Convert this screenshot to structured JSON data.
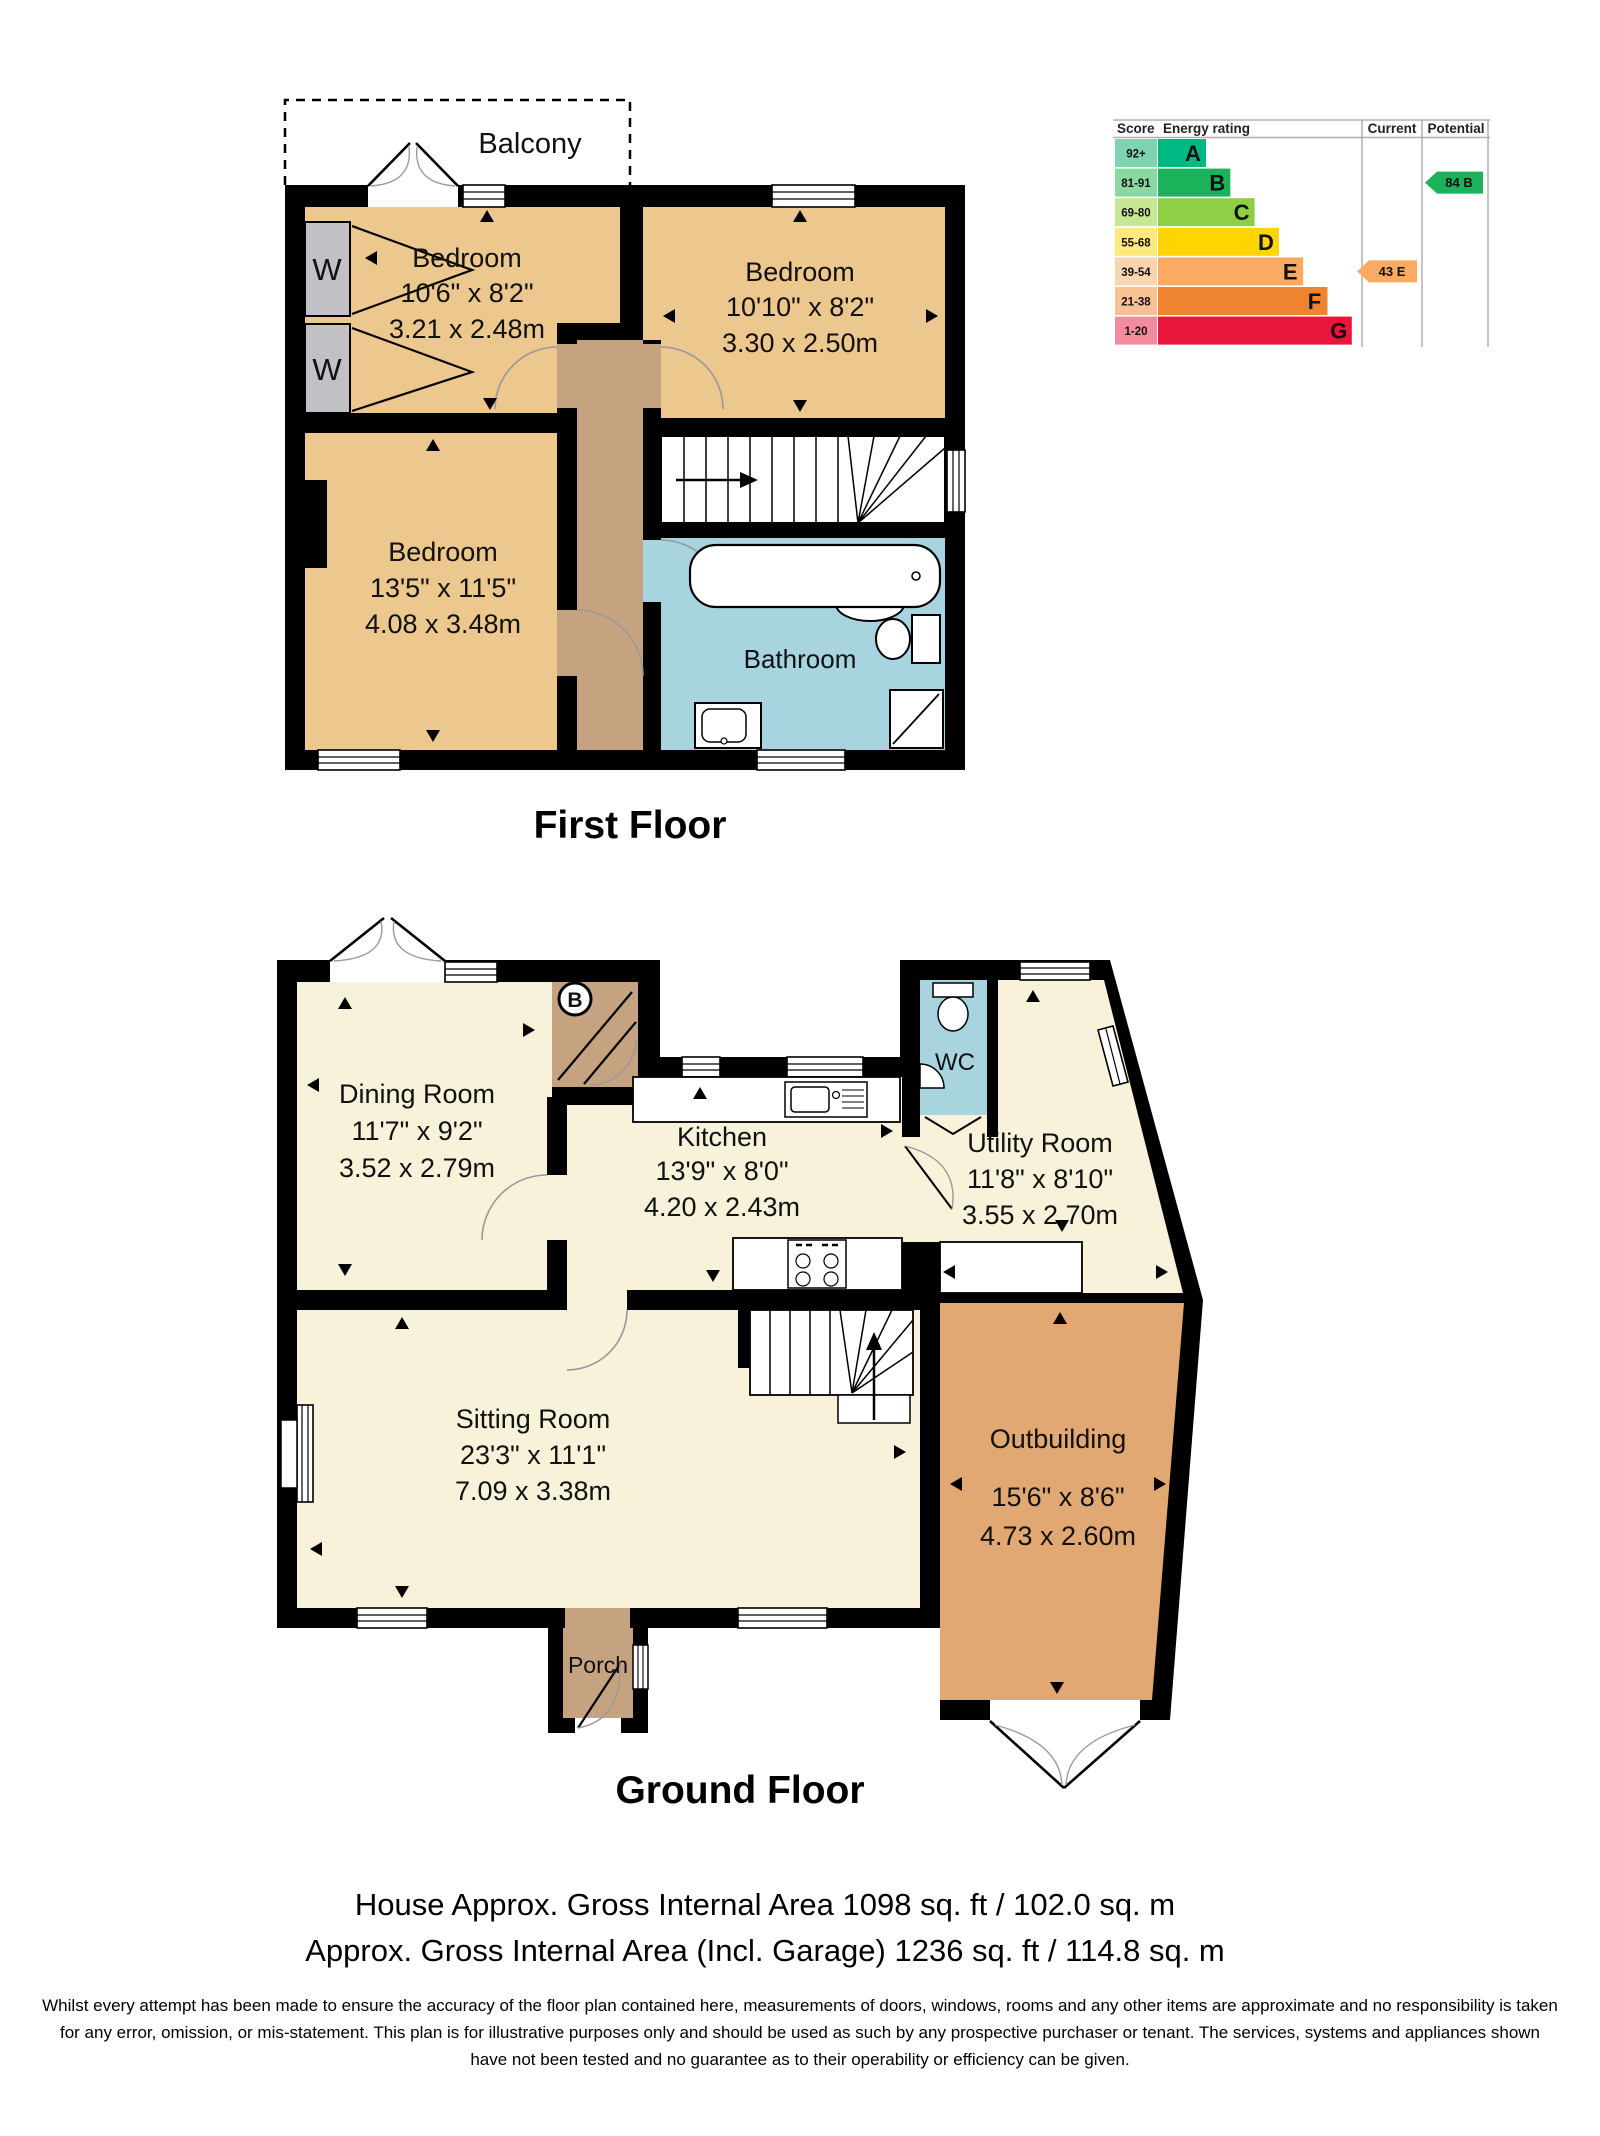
{
  "titles": {
    "first_floor": "First Floor",
    "ground_floor": "Ground Floor"
  },
  "summary": {
    "line1": "House Approx. Gross Internal Area 1098 sq. ft / 102.0 sq. m",
    "line2": "Approx. Gross Internal Area (Incl. Garage) 1236 sq. ft / 114.8 sq. m"
  },
  "disclaimer": "Whilst every attempt has been made to ensure the accuracy of the floor plan contained here, measurements of doors, windows, rooms and any other items are approximate and no responsibility is taken for any error, omission, or mis-statement. This plan is for illustrative purposes only and should be used as such by any prospective purchaser or tenant. The services, systems and appliances shown have not been tested and no guarantee as to their operability or efficiency can be given.",
  "first_floor": {
    "balcony": "Balcony",
    "wardrobe": "W",
    "bedroom1": {
      "name": "Bedroom",
      "imperial": "10'6\" x 8'2\"",
      "metric": "3.21 x 2.48m"
    },
    "bedroom2": {
      "name": "Bedroom",
      "imperial": "10'10\" x 8'2\"",
      "metric": "3.30 x 2.50m"
    },
    "bedroom3": {
      "name": "Bedroom",
      "imperial": "13'5\" x 11'5\"",
      "metric": "4.08 x 3.48m"
    },
    "bathroom": "Bathroom"
  },
  "ground_floor": {
    "boiler": "B",
    "dining": {
      "name": "Dining Room",
      "imperial": "11'7\" x 9'2\"",
      "metric": "3.52 x 2.79m"
    },
    "kitchen": {
      "name": "Kitchen",
      "imperial": "13'9\" x 8'0\"",
      "metric": "4.20 x 2.43m"
    },
    "utility": {
      "name": "Utility Room",
      "imperial": "11'8\" x 8'10\"",
      "metric": "3.55 x 2.70m"
    },
    "wc": "WC",
    "sitting": {
      "name": "Sitting Room",
      "imperial": "23'3\" x 11'1\"",
      "metric": "7.09 x 3.38m"
    },
    "outbuilding": {
      "name": "Outbuilding",
      "imperial": "15'6\" x 8'6\"",
      "metric": "4.73 x 2.60m"
    },
    "porch": "Porch"
  },
  "epc": {
    "headers": {
      "score": "Score",
      "rating": "Energy rating",
      "current": "Current",
      "potential": "Potential"
    },
    "bands": [
      {
        "score": "92+",
        "letter": "A",
        "bar": "#00b881",
        "tint": "#7fd4b0"
      },
      {
        "score": "81-91",
        "letter": "B",
        "bar": "#1ab25a",
        "tint": "#8cd8a2"
      },
      {
        "score": "69-80",
        "letter": "C",
        "bar": "#8ecf45",
        "tint": "#c7e795"
      },
      {
        "score": "55-68",
        "letter": "D",
        "bar": "#ffd400",
        "tint": "#ffe97e"
      },
      {
        "score": "39-54",
        "letter": "E",
        "bar": "#fbaa64",
        "tint": "#fdd4b0"
      },
      {
        "score": "21-38",
        "letter": "F",
        "bar": "#ee8430",
        "tint": "#f7c193"
      },
      {
        "score": "1-20",
        "letter": "G",
        "bar": "#e9153b",
        "tint": "#f28b9e"
      }
    ],
    "current": {
      "label": "43 E",
      "band": "E"
    },
    "potential": {
      "label": "84 B",
      "band": "B"
    }
  },
  "colors": {
    "wall": "#000000",
    "bedroom": "#ecc78e",
    "landing": "#c5a381",
    "bathroom": "#a8d4e0",
    "cream": "#f8f2da",
    "outbuilding": "#e2a873",
    "wardrobe": "#c1c1c5",
    "porch": "#c5a381"
  }
}
